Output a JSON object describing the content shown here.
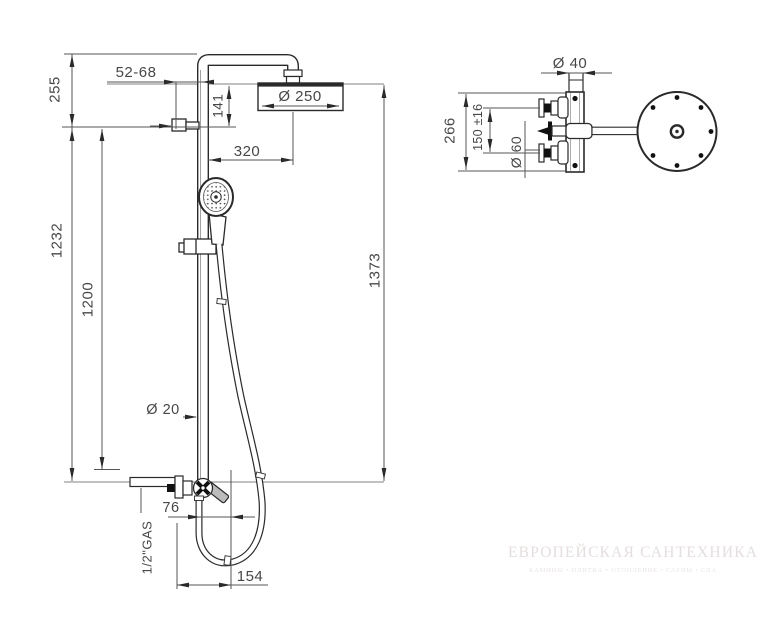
{
  "drawing": {
    "front_view": {
      "dim_top_offset": "255",
      "dim_bracket_range": "52-68",
      "dim_head_drop": "141",
      "dim_head_diameter": "Ø 250",
      "dim_arm_reach": "320",
      "dim_column_height": "1232",
      "dim_rail_length": "1200",
      "dim_pipe_diameter": "Ø 20",
      "dim_total_height": "1373",
      "dim_outlet_offset": "76",
      "dim_hose_loop": "154",
      "dim_inlet_thread": "1/2\"GAS"
    },
    "side_view": {
      "dim_flange_diameter": "Ø 40",
      "dim_plate_height": "266",
      "dim_valve_spacing": "150 ±16",
      "dim_escutcheon_diameter": "Ø 60"
    }
  },
  "watermark": {
    "title": "ЕВРОПЕЙСКАЯ САНТЕХНИКА",
    "subtitle": "КАМИНЫ • ПЛИТКА • ОТОПЛЕНИЕ • САУНЫ • СПА"
  },
  "colors": {
    "line_main": "#2a2a2a",
    "line_dim": "#555555",
    "line_ref": "#9a9a9a",
    "text_dim": "#474747",
    "watermark": "#e5dede"
  }
}
